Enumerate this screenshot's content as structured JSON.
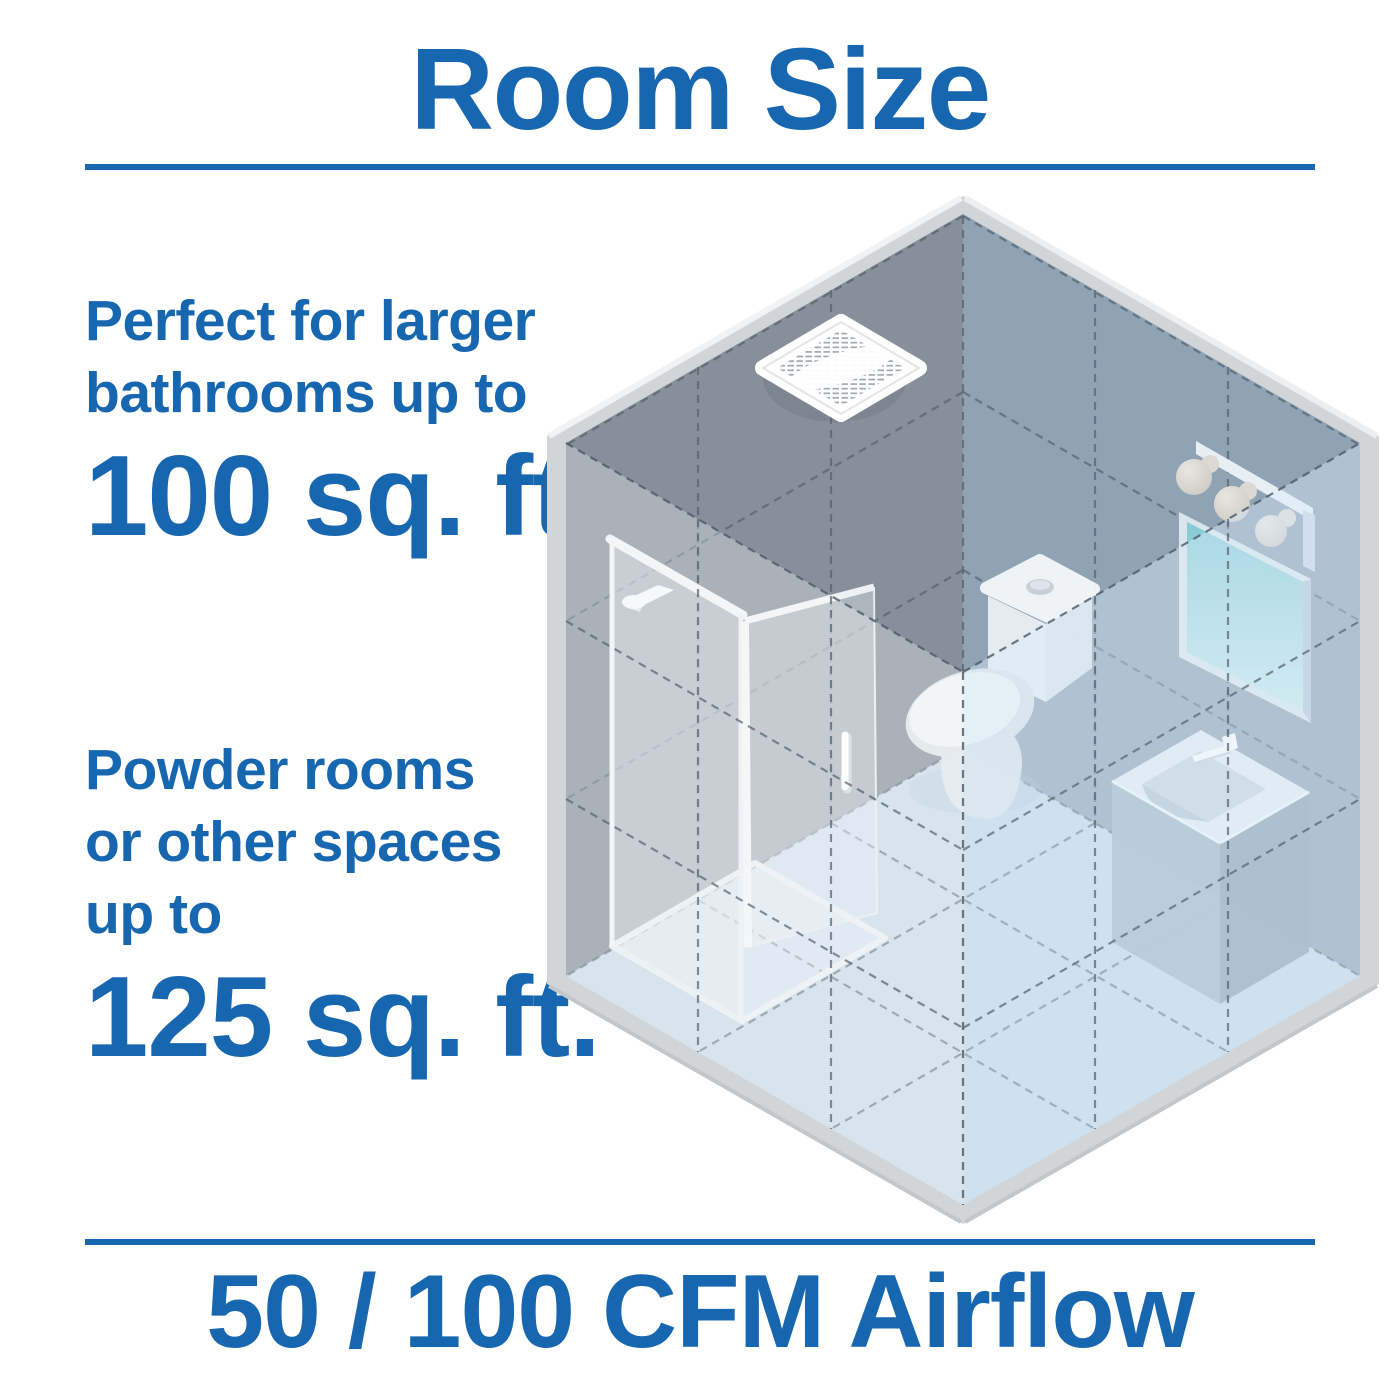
{
  "title": "Room Size",
  "callout_top": {
    "lines": [
      "Perfect for larger",
      "bathrooms up to"
    ],
    "value": "100 sq. ft."
  },
  "callout_bottom": {
    "lines": [
      "Powder rooms",
      "or other spaces",
      "up to"
    ],
    "value": "125 sq. ft."
  },
  "footer": "50 / 100 CFM Airflow",
  "colors": {
    "accent_blue": "#1766b0",
    "wall_left": "#87909a",
    "wall_right": "#8fa3b5",
    "floor": "#c6d8e6",
    "frame": "#d2d5d8",
    "mirror_teal": "#86ccd6"
  },
  "illustration": {
    "description": "isometric cutaway bathroom",
    "items": [
      "exhaust-fan",
      "shower-enclosure",
      "shower-head",
      "toilet",
      "vanity-sink",
      "mirror",
      "vanity-lights"
    ]
  }
}
